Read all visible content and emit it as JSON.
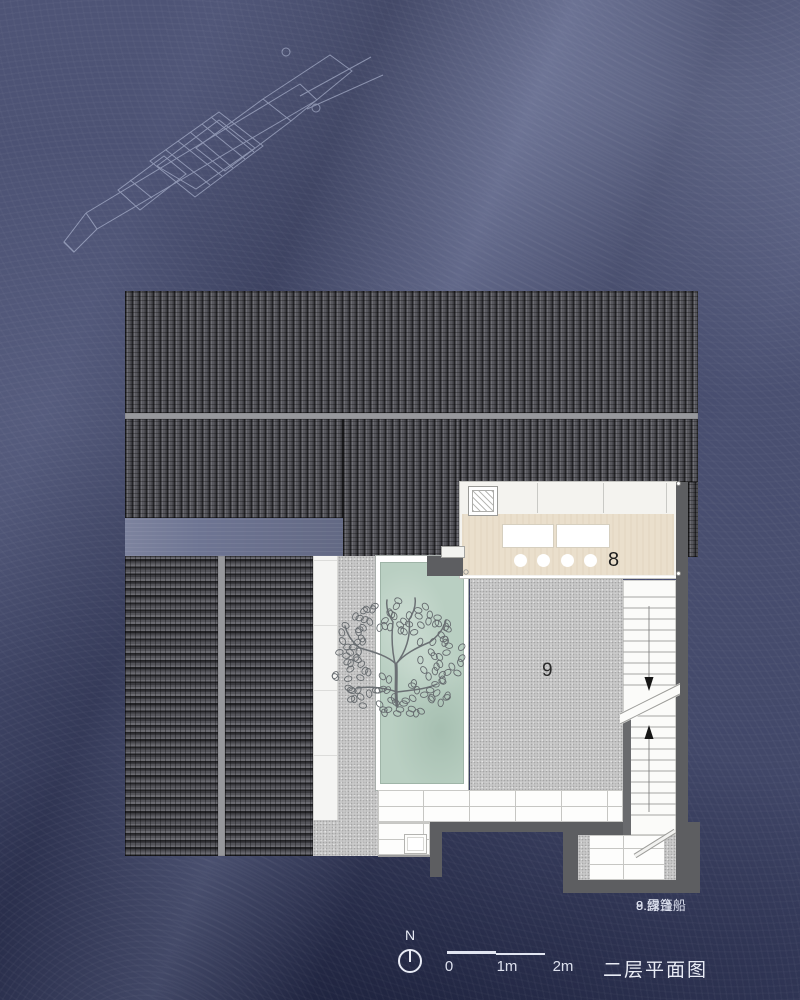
{
  "plan": {
    "labels": {
      "boat_room": "8",
      "terrace": "9"
    }
  },
  "legend": {
    "entries": [
      "8.绿篷船",
      "9.露台"
    ]
  },
  "footer": {
    "north_label": "N",
    "scale_ticks": [
      "0",
      "1m",
      "2m"
    ],
    "title": "二层平面图"
  },
  "colors": {
    "background": "#4a5070",
    "roof_tile": "#47474c",
    "roof_ridge": "#97989c",
    "walkway_blue": "#6e7593",
    "room8_floor": "#eadfcc",
    "terrace_gray": "#c7c7c7",
    "pool_green": "#b9cfc2",
    "wall_dark": "#5d5e61",
    "paving_white": "#fdfdfc",
    "sketch_line": "#cdd6ef",
    "footer_text": "#dde1ee",
    "label_dark": "#1e1e1e"
  }
}
